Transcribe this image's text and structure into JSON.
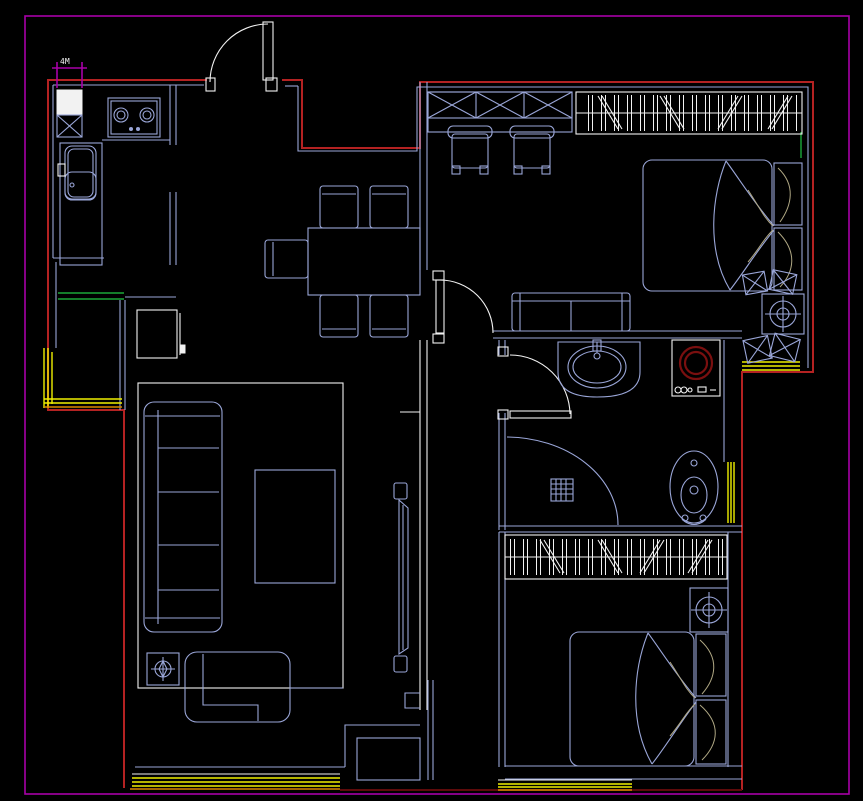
{
  "drawing": {
    "kind": "apartment-floor-plan",
    "dimension_label": "4M"
  },
  "palette": {
    "bg": "#000000",
    "border": "#a800a8",
    "wall": "#b42222",
    "wall_dark": "#5e0a0a",
    "furniture": "#9aa6d8",
    "white": "#f2f2f2",
    "window": "#f0f000",
    "window_orange": "#d98800",
    "green": "#1aa838",
    "drum": "#7a0f0f",
    "tan": "#b0a884"
  },
  "symbols": {
    "entrance-door-icon": "white quarter-arc swing door",
    "interior-door-icon": "white quarter-arc swing door",
    "gas-stove-icon": "two burner circles on counter block",
    "kitchen-sink-icon": "double-basin sink with faucet",
    "shaft-icon": "box with X cross",
    "fridge-icon": "white filled box",
    "wardrobe-hanging-icon": "bar-and-diagonal hatch strip",
    "wardrobe-x-icon": "row of X boxes",
    "bed-icon": "mattress with pillows and folded blanket",
    "sofa-icon": "segmented seat with armrests",
    "dining-set-icon": "table with five chairs",
    "tv-icon": "thin wall-mounted panel",
    "washing-machine-icon": "box with dark-red drum circles",
    "wash-basin-icon": "oval basin on bulged counter",
    "toilet-icon": "oval bowl with cistern dots",
    "shower-icon": "quarter arc with square drain grid",
    "ceiling-lamp-icon": "crosshair circle in box",
    "window-hatch-icon": "parallel yellow lines",
    "cushion-icon": "tilted X pillow"
  }
}
